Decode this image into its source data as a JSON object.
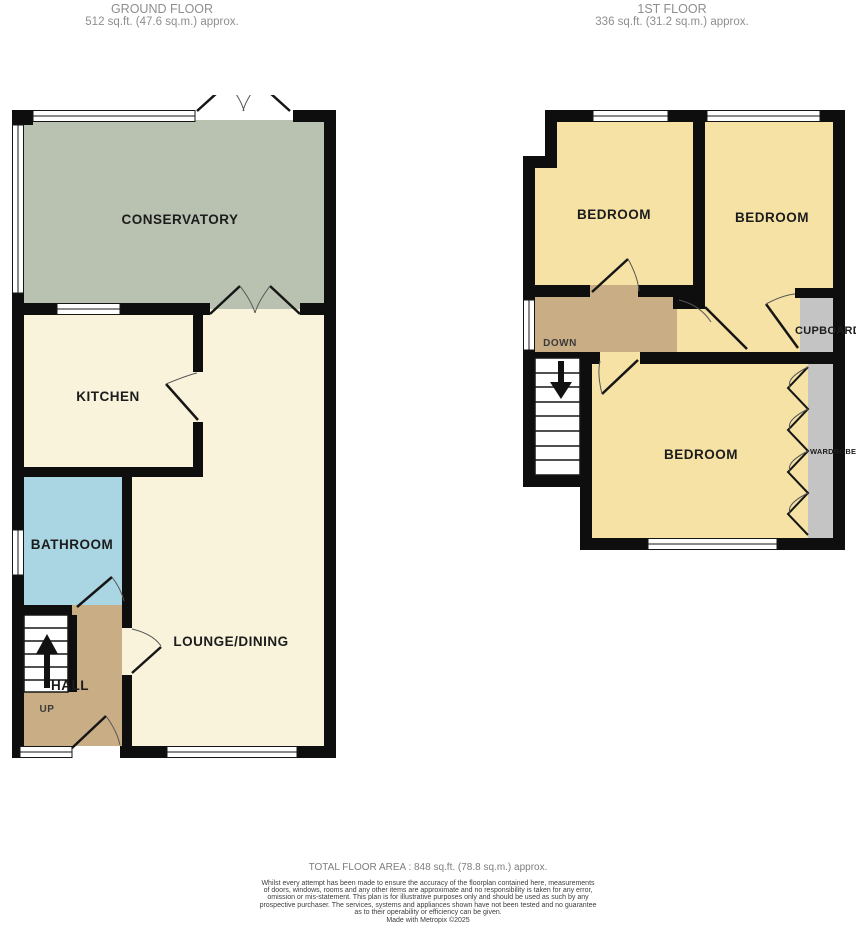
{
  "ground_floor": {
    "title": "GROUND FLOOR",
    "area": "512 sq.ft. (47.6 sq.m.) approx.",
    "rooms": {
      "conservatory": "CONSERVATORY",
      "kitchen": "KITCHEN",
      "bathroom": "BATHROOM",
      "lounge_dining": "LOUNGE/DINING",
      "hall": "HALL",
      "stairs_direction": "UP"
    }
  },
  "first_floor": {
    "title": "1ST FLOOR",
    "area": "336 sq.ft. (31.2 sq.m.) approx.",
    "rooms": {
      "bedroom_1": "BEDROOM",
      "bedroom_2": "BEDROOM",
      "bedroom_3": "BEDROOM",
      "cupboard": "CUPBOARD",
      "wardrobe": "WARDROBE",
      "stairs_direction": "DOWN"
    }
  },
  "footer": {
    "total_area": "TOTAL FLOOR AREA : 848 sq.ft. (78.8 sq.m.) approx.",
    "disclaimer_lines": [
      "Whilst every attempt has been made to ensure the accuracy of the floorplan contained here, measurements",
      "of doors, windows, rooms and any other items are approximate and no responsibility is taken for any error,",
      "omission or mis-statement. This plan is for illustrative purposes only and should be used as such by any",
      "prospective purchaser. The services, systems and appliances shown have not been tested and no guarantee",
      "as to their operability or efficiency can be given."
    ],
    "credit": "Made with Metropix ©2025"
  },
  "colors": {
    "wall": "#0e0e0e",
    "conservatory": "#b9c1b0",
    "cream": "#f9f3dc",
    "bathroom": "#aad5e2",
    "hall": "#c9ad85",
    "bedroom": "#f5e2a4",
    "storage": "#c4c4c4"
  }
}
